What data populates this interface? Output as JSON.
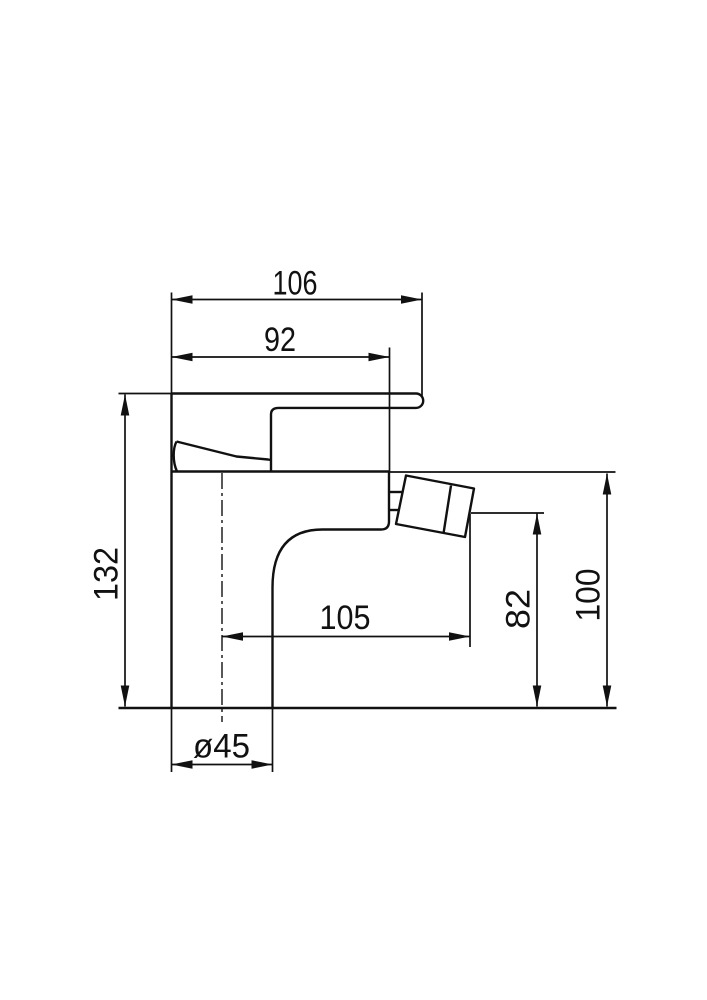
{
  "colors": {
    "background": "#ffffff",
    "line": "#111111"
  },
  "dimensions": {
    "overall_width": "106",
    "deck_width": "92",
    "overall_height": "132",
    "deck_height": "100",
    "spout_outlet_height": "82",
    "spout_reach": "105",
    "base_diameter": "ø45"
  }
}
